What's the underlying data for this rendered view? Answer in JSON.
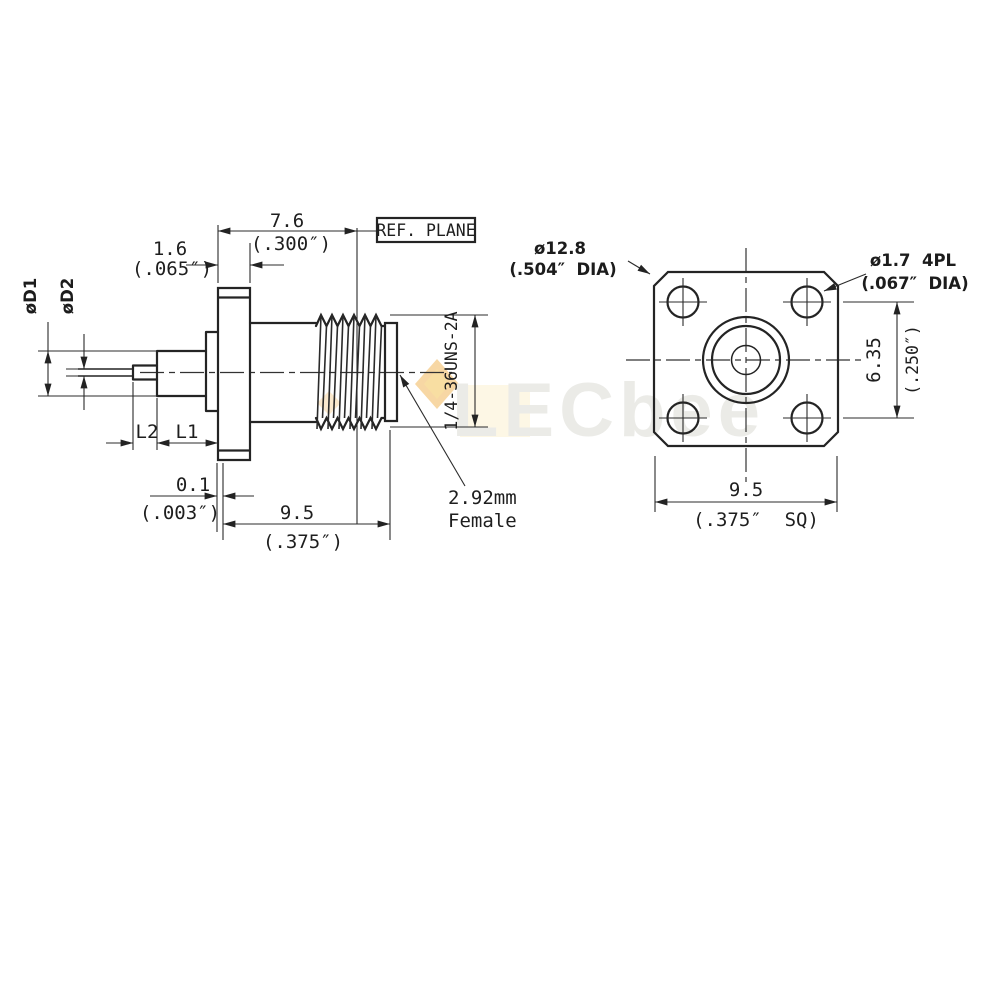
{
  "drawing": {
    "side_view": {
      "ref_plane_label": "REF. PLANE",
      "dim_7_6_mm": "7.6",
      "dim_7_6_in": "(.300″)",
      "dim_1_6_mm": "1.6",
      "dim_1_6_in": "(.065″)",
      "dia_d1_label": "øD1",
      "dia_d2_label": "øD2",
      "len_l2_label": "L2",
      "len_l1_label": "L1",
      "dim_0_1_mm": "0.1",
      "dim_0_1_in": "(.003″)",
      "dim_9_5_mm": "9.5",
      "dim_9_5_in": "(.375″)",
      "thread_spec": "1/4-36UNS-2A",
      "connector_label_line1": "2.92mm",
      "connector_label_line2": "Female"
    },
    "front_view": {
      "flange_dia_mm": "ø12.8",
      "flange_dia_in": "(.504″  DIA)",
      "hole_dia_mm": "ø1.7  4PL",
      "hole_dia_in": "(.067″  DIA)",
      "hole_pitch_mm": "6.35",
      "hole_pitch_in": "(.250″)",
      "square_mm": "9.5",
      "square_in": "(.375″  SQ)"
    }
  },
  "watermark": {
    "text": "LECbee"
  },
  "colors": {
    "line": "#242424",
    "accent_diamond": "#f0b04a",
    "watermark_text": "#ebebe7"
  }
}
